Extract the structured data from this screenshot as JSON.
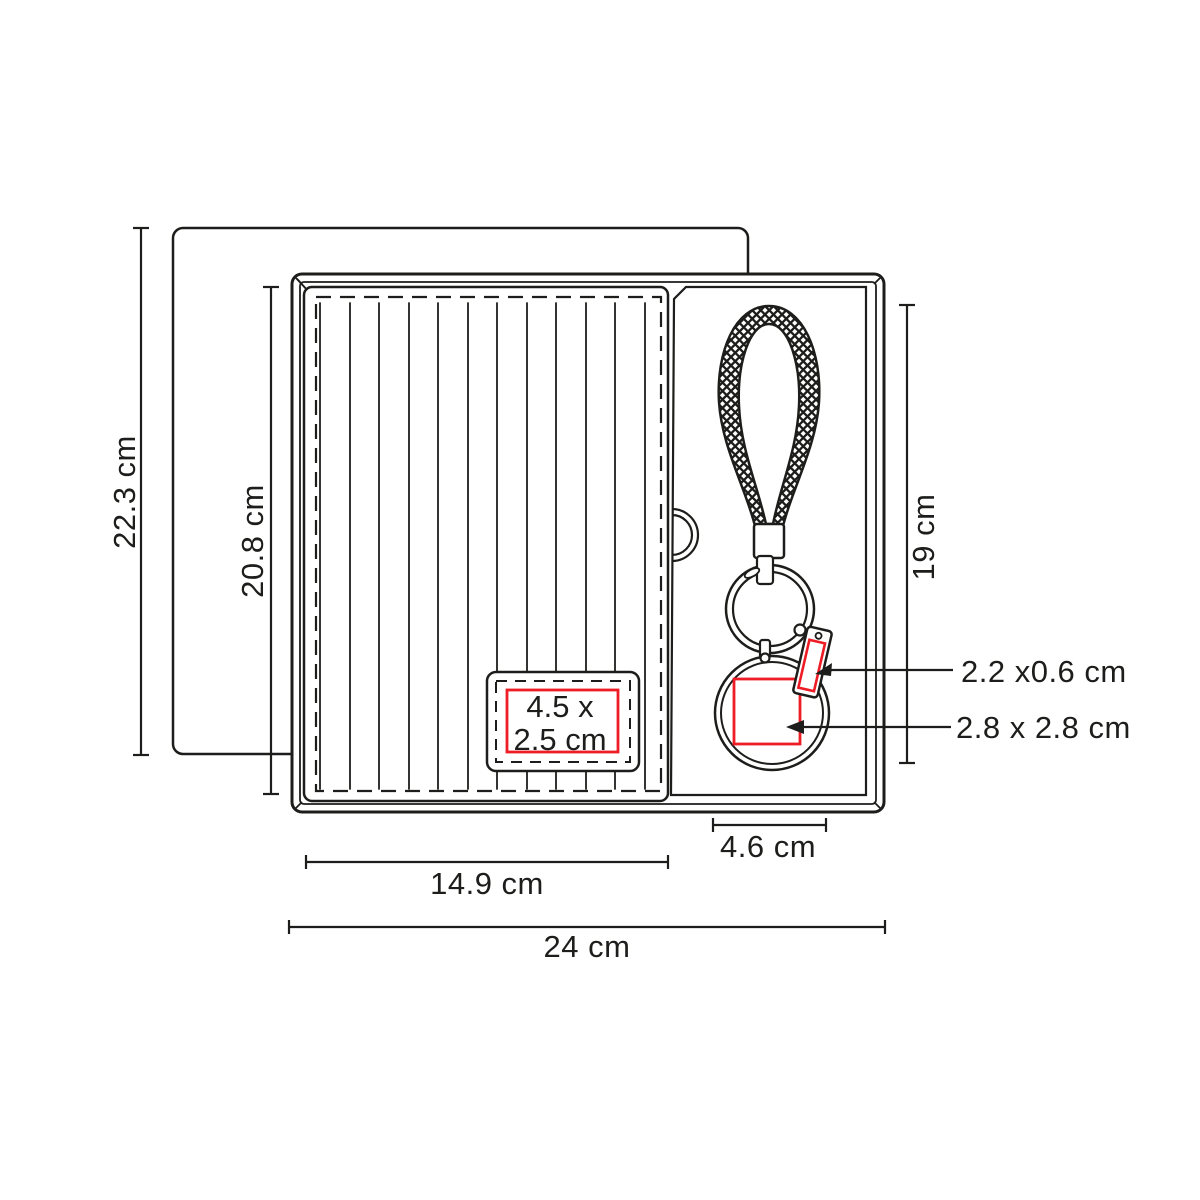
{
  "diagram": {
    "type": "product-dimension-diagram",
    "product": "gift-set-box-with-notebook-and-braided-keychain",
    "colors": {
      "outline": "#1d1d1b",
      "print_area": "#ee1c25",
      "background": "#ffffff"
    },
    "labels": {
      "back_card_height": "22.3 cm",
      "notebook_height": "20.8 cm",
      "keychain_length": "19 cm",
      "notebook_print_area": {
        "line1": "4.5 x",
        "line2": "2.5 cm"
      },
      "tag_print_area": "2.2 x0.6 cm",
      "disc_print_area": "2.8 x 2.8 cm",
      "keychain_tray_width": "4.6 cm",
      "notebook_width": "14.9 cm",
      "box_width": "24 cm"
    }
  }
}
